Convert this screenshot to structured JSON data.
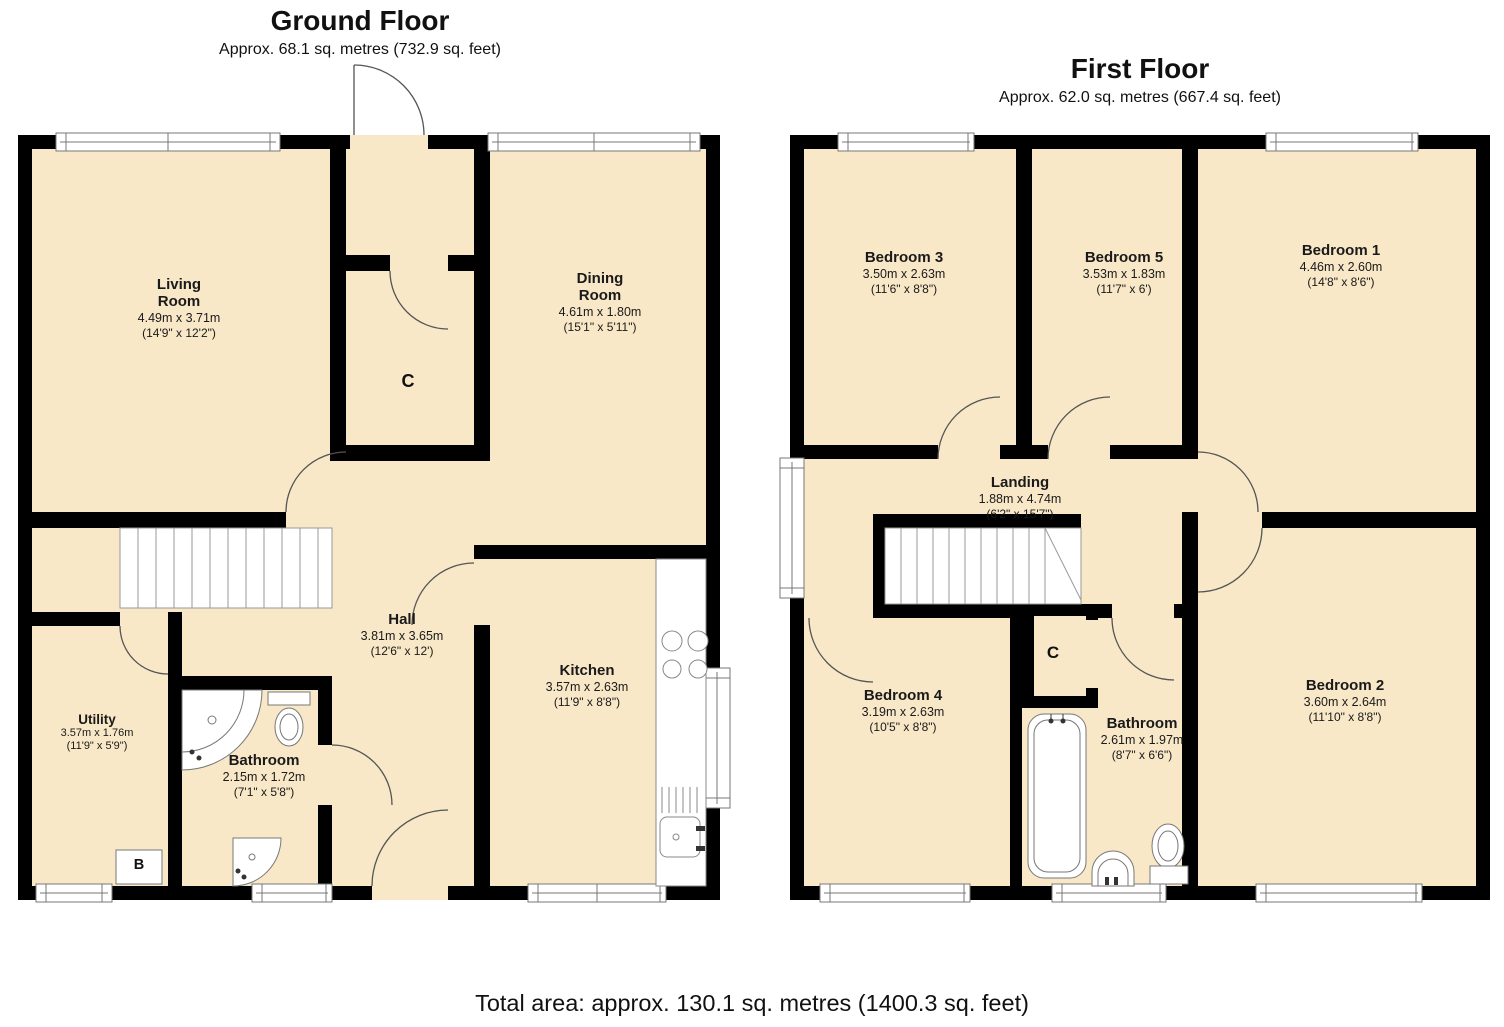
{
  "page": {
    "total_area": "Total area: approx. 130.1 sq. metres (1400.3 sq. feet)"
  },
  "colors": {
    "room_fill": "#F8E8C8",
    "wall": "#000000",
    "fixture_stroke": "#777777"
  },
  "ground_floor": {
    "title": "Ground Floor",
    "subtitle": "Approx. 68.1 sq. metres (732.9 sq. feet)",
    "rooms": {
      "living_room": {
        "name": "Living Room",
        "metric": "4.49m x 3.71m",
        "imperial": "(14'9\" x 12'2\")"
      },
      "dining_room": {
        "name": "Dining Room",
        "metric": "4.61m x 1.80m",
        "imperial": "(15'1\" x 5'11\")"
      },
      "hall": {
        "name": "Hall",
        "metric": "3.81m x 3.65m",
        "imperial": "(12'6\" x 12')"
      },
      "kitchen": {
        "name": "Kitchen",
        "metric": "3.57m x 2.63m",
        "imperial": "(11'9\" x 8'8\")"
      },
      "utility": {
        "name": "Utility",
        "metric": "3.57m x 1.76m",
        "imperial": "(11'9\" x 5'9\")"
      },
      "bathroom": {
        "name": "Bathroom",
        "metric": "2.15m x 1.72m",
        "imperial": "(7'1\" x 5'8\")"
      },
      "cupboard": {
        "name": "C"
      },
      "boiler": {
        "name": "B"
      }
    }
  },
  "first_floor": {
    "title": "First Floor",
    "subtitle": "Approx. 62.0 sq. metres (667.4 sq. feet)",
    "rooms": {
      "bedroom_1": {
        "name": "Bedroom 1",
        "metric": "4.46m x 2.60m",
        "imperial": "(14'8\" x 8'6\")"
      },
      "bedroom_2": {
        "name": "Bedroom 2",
        "metric": "3.60m x 2.64m",
        "imperial": "(11'10\" x 8'8\")"
      },
      "bedroom_3": {
        "name": "Bedroom 3",
        "metric": "3.50m x 2.63m",
        "imperial": "(11'6\" x 8'8\")"
      },
      "bedroom_4": {
        "name": "Bedroom 4",
        "metric": "3.19m x 2.63m",
        "imperial": "(10'5\" x 8'8\")"
      },
      "bedroom_5": {
        "name": "Bedroom 5",
        "metric": "3.53m x 1.83m",
        "imperial": "(11'7\" x 6')"
      },
      "landing": {
        "name": "Landing",
        "metric": "1.88m x 4.74m",
        "imperial": "(6'2\" x 15'7\")"
      },
      "bathroom": {
        "name": "Bathroom",
        "metric": "2.61m x 1.97m",
        "imperial": "(8'7\" x 6'6\")"
      },
      "cupboard": {
        "name": "C"
      }
    }
  }
}
